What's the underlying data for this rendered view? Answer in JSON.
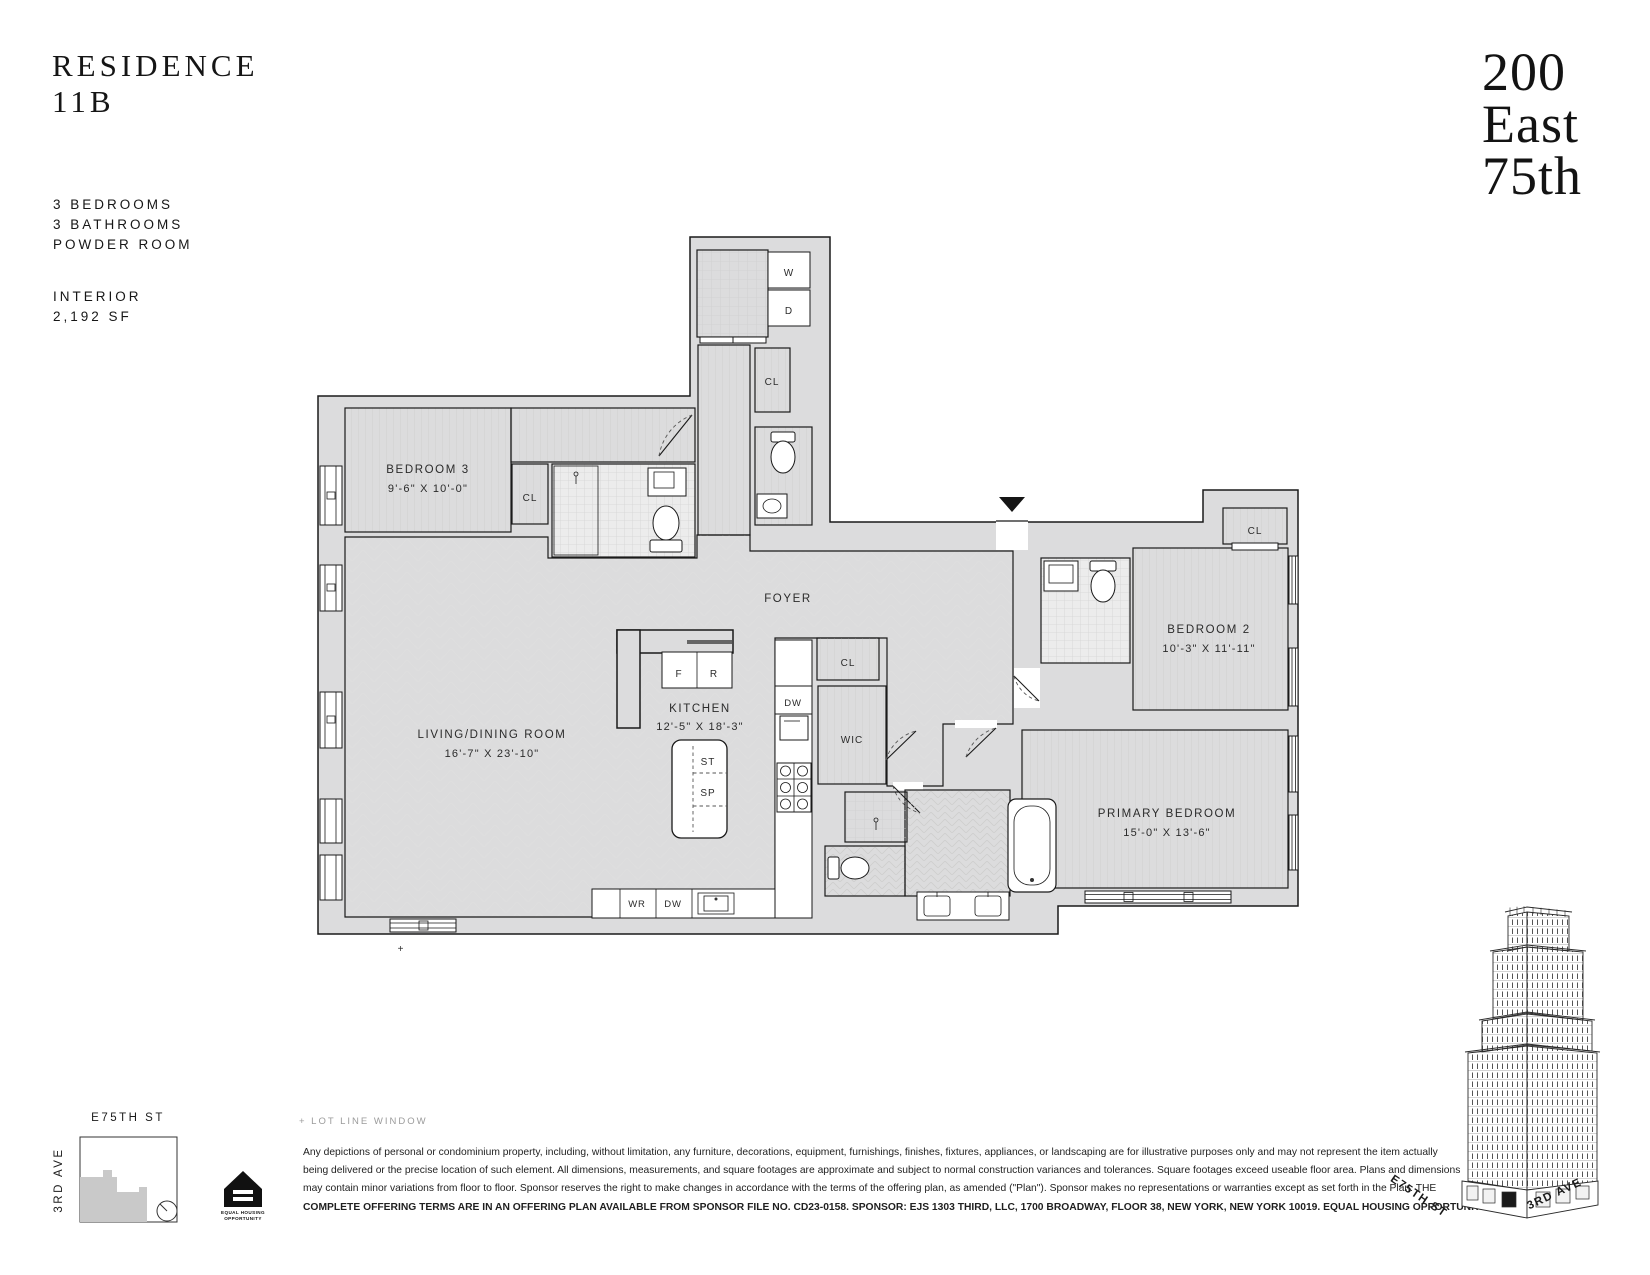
{
  "header": {
    "title_line1": "RESIDENCE",
    "title_line2": "11B",
    "spec_lines": [
      "3 BEDROOMS",
      "3 BATHROOMS",
      "POWDER ROOM"
    ],
    "interior_label": "INTERIOR",
    "interior_area": "2,192 SF"
  },
  "brand": {
    "line1": "200",
    "line2": "East",
    "line3": "75th"
  },
  "plan": {
    "rooms": {
      "living": {
        "name": "LIVING/DINING ROOM",
        "dims": "16'-7\" X 23'-10\""
      },
      "kitchen": {
        "name": "KITCHEN",
        "dims": "12'-5\" X 18'-3\""
      },
      "foyer": {
        "name": "FOYER"
      },
      "bedroom3": {
        "name": "BEDROOM 3",
        "dims": "9'-6\" X 10'-0\""
      },
      "bedroom2": {
        "name": "BEDROOM 2",
        "dims": "10'-3\" X 11'-11\""
      },
      "primary": {
        "name": "PRIMARY BEDROOM",
        "dims": "15'-0\" X 13'-6\""
      },
      "wic": {
        "name": "WIC"
      }
    },
    "fixtures": {
      "closet": "CL",
      "washer": "W",
      "dryer": "D",
      "fridge": "F",
      "range": "R",
      "storage_top": "ST",
      "storage_bottom": "SP",
      "dishwasher": "DW",
      "wine_fridge": "WR"
    },
    "lot_line_marker": "+"
  },
  "keyplan": {
    "street_top": "E75TH ST",
    "street_side": "3RD AVE"
  },
  "legend": {
    "lot_line_window": "+ LOT LINE WINDOW"
  },
  "equal_housing": {
    "line1": "EQUAL HOUSING",
    "line2": "OPPORTUNITY"
  },
  "building": {
    "street_left": "E75TH ST",
    "street_right": "3RD AVE"
  },
  "disclaimer": {
    "line1": "Any depictions of personal or condominium property, including, without limitation, any furniture, decorations, equipment, furnishings, finishes, fixtures, appliances, or landscaping are for illustrative purposes only and may not represent the item actually",
    "line2": "being delivered or the precise location of such element. All dimensions, measurements, and square footages are approximate and subject to normal construction variances and tolerances. Square footages exceed useable floor area. Plans and dimensions",
    "line3": "may contain minor variations from floor to floor. Sponsor reserves the right to make changes in accordance with the terms of the offering plan, as amended (\"Plan\"). Sponsor makes no representations or warranties except as set forth in the Plan. THE",
    "line4": "COMPLETE OFFERING TERMS ARE IN AN OFFERING PLAN AVAILABLE FROM SPONSOR FILE NO. CD23-0158. SPONSOR: EJS 1303 THIRD, LLC, 1700 BROADWAY, FLOOR 38, NEW YORK, NEW YORK 10019. EQUAL HOUSING OPPORTUNITY."
  },
  "colors": {
    "wall_fill": "#dcdcdd",
    "line": "#1a1a1a",
    "unit_gray": "#c9c9c9"
  }
}
